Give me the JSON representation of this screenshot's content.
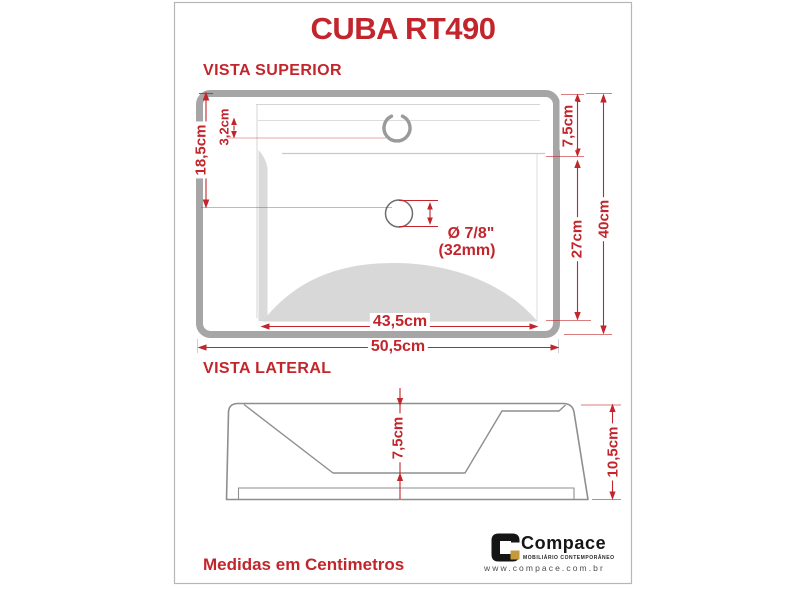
{
  "window": {
    "title": "CUBA RT490"
  },
  "top_view": {
    "heading": "VISTA SUPERIOR",
    "dimensions": {
      "rim_to_drain": "18,5cm",
      "faucet_offset": "3,2cm",
      "rim_to_deck": "7,5cm",
      "basin_length": "27cm",
      "total_depth": "40cm",
      "inner_width": "43,5cm",
      "outer_width": "50,5cm"
    },
    "drain": {
      "diameter_inches": "Ø 7/8\"",
      "diameter_mm": "(32mm)"
    }
  },
  "side_view": {
    "heading": "VISTA LATERAL",
    "dimensions": {
      "bowl_depth": "7,5cm",
      "total_height": "10,5cm"
    }
  },
  "footer": {
    "note": "Medidas em Centimetros",
    "brand": {
      "name": "Compace",
      "tagline": "MOBILIÁRIO CONTEMPORÂNEO",
      "website": "www.compace.com.br"
    }
  },
  "colors": {
    "accent_red": "#c2262c",
    "drawing_gray": "#a6a6a6",
    "shade_gray": "#d8d8d8",
    "brand_gold": "#c49a3c",
    "brand_black": "#151515"
  }
}
